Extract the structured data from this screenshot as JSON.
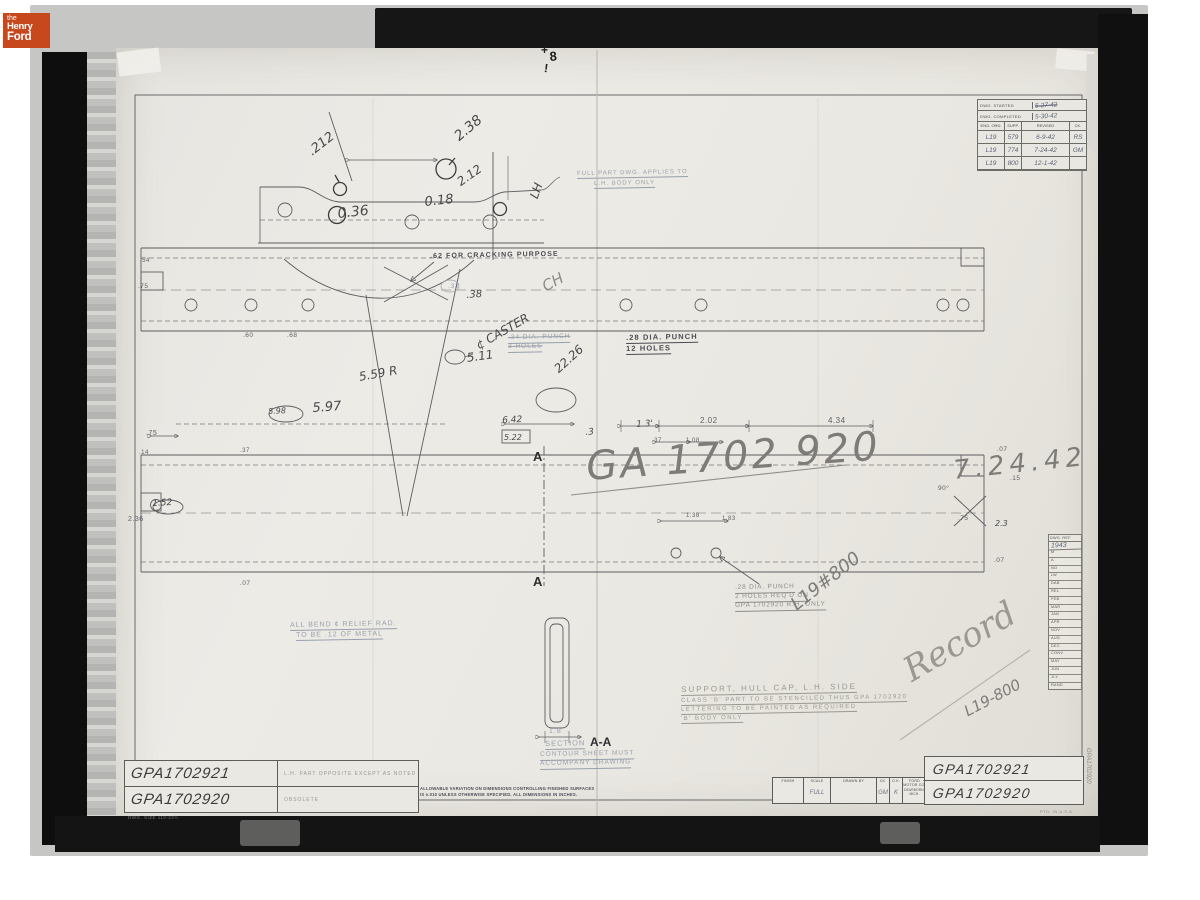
{
  "logo": {
    "the": "the",
    "henry": "Henry",
    "ford": "Ford"
  },
  "revision": {
    "started_label": "DWG. STARTED",
    "started_value": "5-27-42",
    "completed_label": "DWG. COMPLETED",
    "completed_value": "5-30-42",
    "columns": [
      "ENG. ORD.",
      "SUPP.",
      "REVISED",
      "CK."
    ],
    "rows": [
      [
        "L19",
        "579",
        "6-9-42",
        "RS"
      ],
      [
        "L19",
        "774",
        "7-24-42",
        "GM"
      ],
      [
        "L19",
        "800",
        "12-1-42",
        ""
      ]
    ]
  },
  "calendar": {
    "header": "DWG. REF.",
    "year": "1943",
    "rows": [
      "M",
      "A",
      "NO",
      "LW",
      "DAB",
      "REL",
      "FEB",
      "MAR",
      "JAN",
      "APR",
      "NOV",
      "AUG",
      "DEC",
      "CONV",
      "MAY",
      "JUN",
      "JLY",
      "RAND"
    ]
  },
  "title_left": {
    "rows": [
      {
        "number": "GPA1702921",
        "desc": "L.H. PART OPPOSITE EXCEPT AS NOTED"
      },
      {
        "number": "GPA1702920",
        "desc": "OBSOLETE"
      }
    ],
    "size_note": "DWG. SIZE 110-22½"
  },
  "title_right": {
    "cells": [
      {
        "label": "FINISH",
        "value": ""
      },
      {
        "label": "SCALE",
        "value": "FULL"
      },
      {
        "label": "DRAWN BY",
        "value": ""
      },
      {
        "label": "CK.",
        "value": "GM"
      },
      {
        "label": "O.K.",
        "value": "K"
      },
      {
        "label": "FORD MOTOR CO.",
        "value": "DEARBORN, MICH."
      }
    ],
    "numbers": [
      "GPA1702921",
      "GPA1702920"
    ],
    "ptd": "PTD. IN U.S.A."
  },
  "tolerance_note": {
    "line1": "ALLOWABLE VARIATION ON DIMENSIONS CONTROLLING FINISHED SURFACES",
    "line2": "IS ±.010 UNLESS OTHERWISE SPECIFIED.   ALL DIMENSIONS IN INCHES."
  },
  "annotations": [
    {
      "n": "dim-212",
      "t": ".212",
      "x": 306,
      "y": 148,
      "s": 13,
      "r": -38,
      "c": "hand"
    },
    {
      "n": "dim-238",
      "t": "2.38",
      "x": 452,
      "y": 133,
      "s": 14,
      "r": -40,
      "c": "hand"
    },
    {
      "n": "dim-212v",
      "t": "2.12",
      "x": 455,
      "y": 178,
      "s": 12,
      "r": -35,
      "c": "hand"
    },
    {
      "n": "dim-018",
      "t": "0.18",
      "x": 424,
      "y": 196,
      "s": 13,
      "r": -6,
      "c": "hand"
    },
    {
      "n": "dim-036",
      "t": "0.36",
      "x": 337,
      "y": 207,
      "s": 14,
      "r": -6,
      "c": "hand"
    },
    {
      "n": "lh-mark",
      "t": "LH",
      "x": 528,
      "y": 196,
      "s": 12,
      "r": -70,
      "c": "hand"
    },
    {
      "n": "note-top-faint1",
      "t": "FULL PART DWG. APPLIES TO",
      "x": 577,
      "y": 171,
      "s": 6,
      "r": -1,
      "c": "faintblue",
      "u": 1
    },
    {
      "n": "note-top-faint2",
      "t": "L.H. BODY ONLY",
      "x": 594,
      "y": 181,
      "s": 6,
      "r": -1,
      "c": "faintblue",
      "u": 1
    },
    {
      "n": "fold-mark-plus",
      "t": "+",
      "x": 541,
      "y": 44,
      "s": 12,
      "r": 0,
      "c": "mark"
    },
    {
      "n": "fold-mark-8",
      "t": "8",
      "x": 549,
      "y": 50,
      "s": 13,
      "r": -5,
      "c": "mark"
    },
    {
      "n": "fold-mark-excl",
      "t": "!",
      "x": 545,
      "y": 62,
      "s": 12,
      "r": 8,
      "c": "mark"
    },
    {
      "n": "note-cracking",
      "t": ".62 FOR CRACKING PURPOSE",
      "x": 430,
      "y": 253,
      "s": 7,
      "r": -1,
      "c": "lettered"
    },
    {
      "n": "dim-37-circled",
      "t": ".37",
      "x": 448,
      "y": 284,
      "s": 6.5,
      "r": 0,
      "c": "faintblue"
    },
    {
      "n": "dim-38",
      "t": ".38",
      "x": 466,
      "y": 291,
      "s": 10,
      "r": -4,
      "c": "hand"
    },
    {
      "n": "mark-ch",
      "t": "CH",
      "x": 540,
      "y": 281,
      "s": 15,
      "r": -28,
      "c": "handbig"
    },
    {
      "n": "note-punch34a",
      "t": ".34 DIA. PUNCH",
      "x": 508,
      "y": 335,
      "s": 6.5,
      "r": -1,
      "c": "faintblue struck",
      "u": 1
    },
    {
      "n": "note-punch34b",
      "t": "3 HOLES",
      "x": 508,
      "y": 344,
      "s": 6.5,
      "r": -1,
      "c": "faintblue struck",
      "u": 1
    },
    {
      "n": "note-punch28a",
      "t": ".28 DIA. PUNCH",
      "x": 626,
      "y": 334,
      "s": 7.5,
      "r": -1,
      "c": "lettered",
      "u": 1
    },
    {
      "n": "note-punch28b",
      "t": "12 HOLES",
      "x": 626,
      "y": 345,
      "s": 7.5,
      "r": -1,
      "c": "lettered",
      "u": 1
    },
    {
      "n": "dim-60",
      "t": ".60",
      "x": 243,
      "y": 333,
      "s": 6.5,
      "r": 0,
      "c": "print"
    },
    {
      "n": "dim-68",
      "t": ".68",
      "x": 287,
      "y": 333,
      "s": 6.5,
      "r": 0,
      "c": "print"
    },
    {
      "n": "note-caster",
      "t": "¢ CASTER",
      "x": 474,
      "y": 341,
      "s": 12,
      "r": -30,
      "c": "hand"
    },
    {
      "n": "dim-559r",
      "t": "5.59 R",
      "x": 358,
      "y": 371,
      "s": 12,
      "r": -10,
      "c": "hand"
    },
    {
      "n": "dim-511",
      "t": "5.11",
      "x": 466,
      "y": 352,
      "s": 12,
      "r": -8,
      "c": "hand"
    },
    {
      "n": "dim-2226",
      "t": "22.26",
      "x": 552,
      "y": 366,
      "s": 12,
      "r": -42,
      "c": "hand"
    },
    {
      "n": "dim-597",
      "t": "5.97",
      "x": 312,
      "y": 402,
      "s": 13,
      "r": -4,
      "c": "hand"
    },
    {
      "n": "dim-598",
      "t": "5.98",
      "x": 268,
      "y": 408,
      "s": 8,
      "r": -3,
      "c": "hand"
    },
    {
      "n": "dim-75-left",
      "t": ".75",
      "x": 146,
      "y": 430,
      "s": 7,
      "r": 0,
      "c": "print"
    },
    {
      "n": "dim-14",
      "t": ".14",
      "x": 139,
      "y": 450,
      "s": 6,
      "r": 0,
      "c": "print"
    },
    {
      "n": "dim-37-left",
      "t": ".37",
      "x": 240,
      "y": 448,
      "s": 6,
      "r": 0,
      "c": "print"
    },
    {
      "n": "dim-642",
      "t": "6.42",
      "x": 502,
      "y": 417,
      "s": 9,
      "r": -3,
      "c": "hand"
    },
    {
      "n": "dim-522",
      "t": "5.22",
      "x": 504,
      "y": 434,
      "s": 8,
      "r": 0,
      "c": "hand"
    },
    {
      "n": "dim-3",
      "t": ".3",
      "x": 585,
      "y": 429,
      "s": 9,
      "r": -5,
      "c": "hand"
    },
    {
      "n": "dim-13",
      "t": "1.3'",
      "x": 636,
      "y": 421,
      "s": 9,
      "r": -3,
      "c": "hand"
    },
    {
      "n": "dim-202",
      "t": "2.02",
      "x": 700,
      "y": 417,
      "s": 8,
      "r": 0,
      "c": "print"
    },
    {
      "n": "dim-434",
      "t": "4.34",
      "x": 828,
      "y": 417,
      "s": 8,
      "r": 0,
      "c": "print"
    },
    {
      "n": "dim-37-mid",
      "t": ".37",
      "x": 652,
      "y": 438,
      "s": 6,
      "r": 0,
      "c": "print"
    },
    {
      "n": "dim-108",
      "t": "1.08",
      "x": 686,
      "y": 438,
      "s": 6,
      "r": 0,
      "c": "print"
    },
    {
      "n": "big-part-number",
      "t": "GA 1702 920",
      "x": 585,
      "y": 447,
      "s": 40,
      "r": -4,
      "c": "graphite",
      "ls": 3
    },
    {
      "n": "date-7-24-42",
      "t": "7.24.42",
      "x": 952,
      "y": 458,
      "s": 26,
      "r": -6,
      "c": "graphite",
      "ls": 5
    },
    {
      "n": "dim-152",
      "t": "1.52",
      "x": 152,
      "y": 500,
      "s": 9,
      "r": -3,
      "c": "hand"
    },
    {
      "n": "dim-236",
      "t": "2.36",
      "x": 128,
      "y": 516,
      "s": 7,
      "r": 0,
      "c": "print"
    },
    {
      "n": "dim-138",
      "t": "1.38",
      "x": 686,
      "y": 513,
      "s": 6,
      "r": 0,
      "c": "print"
    },
    {
      "n": "dim-183",
      "t": "1.83",
      "x": 722,
      "y": 516,
      "s": 6,
      "r": 0,
      "c": "print"
    },
    {
      "n": "dim-07-r1",
      "t": ".07",
      "x": 997,
      "y": 447,
      "s": 6.5,
      "r": 0,
      "c": "print"
    },
    {
      "n": "dim-90deg",
      "t": "90°",
      "x": 938,
      "y": 486,
      "s": 6.5,
      "r": 0,
      "c": "print"
    },
    {
      "n": "dim-15",
      "t": ".15",
      "x": 1010,
      "y": 476,
      "s": 6.5,
      "r": 0,
      "c": "print"
    },
    {
      "n": "dim-75-right",
      "t": ".75",
      "x": 958,
      "y": 516,
      "s": 6.5,
      "r": 0,
      "c": "print"
    },
    {
      "n": "dim-23",
      "t": "2.3",
      "x": 995,
      "y": 520,
      "s": 8,
      "r": 0,
      "c": "hand"
    },
    {
      "n": "dim-07-r2",
      "t": ".07",
      "x": 994,
      "y": 558,
      "s": 6.5,
      "r": 0,
      "c": "print"
    },
    {
      "n": "dim-07-left",
      "t": ".07",
      "x": 240,
      "y": 581,
      "s": 6.5,
      "r": 0,
      "c": "print"
    },
    {
      "n": "dim-54",
      "t": ".54",
      "x": 140,
      "y": 258,
      "s": 6,
      "r": 0,
      "c": "print"
    },
    {
      "n": "dim-75-band",
      "t": ".75",
      "x": 138,
      "y": 284,
      "s": 6.5,
      "r": 0,
      "c": "print"
    },
    {
      "n": "section-mark-a-top",
      "t": "A",
      "x": 533,
      "y": 450,
      "s": 13,
      "r": 0,
      "c": "amark"
    },
    {
      "n": "section-mark-a-bottom",
      "t": "A",
      "x": 533,
      "y": 575,
      "s": 13,
      "r": 0,
      "c": "amark"
    },
    {
      "n": "note-bend1",
      "t": "ALL BEND ¢ RELIEF RAD.",
      "x": 290,
      "y": 622,
      "s": 7,
      "r": -1,
      "c": "faintblue",
      "u": 1
    },
    {
      "n": "note-bend2",
      "t": "TO BE .12 OF METAL",
      "x": 296,
      "y": 632,
      "s": 7,
      "r": -1,
      "c": "faintblue",
      "u": 1
    },
    {
      "n": "note-punch2a",
      "t": ".28 DIA. PUNCH",
      "x": 735,
      "y": 585,
      "s": 6.5,
      "r": -1,
      "c": "faintlet",
      "u": 1
    },
    {
      "n": "note-punch2b",
      "t": "2 HOLES REQ'D ON",
      "x": 735,
      "y": 594,
      "s": 6.5,
      "r": -1,
      "c": "faintlet",
      "u": 1
    },
    {
      "n": "note-punch2c",
      "t": "GPA 1702920  R.H. ONLY",
      "x": 735,
      "y": 603,
      "s": 6.5,
      "r": -1,
      "c": "faintlet",
      "u": 1
    },
    {
      "n": "hand-l19-800a",
      "t": "L19#800",
      "x": 788,
      "y": 600,
      "s": 18,
      "r": -38,
      "c": "graphite"
    },
    {
      "n": "section-dim-18",
      "t": "1.8",
      "x": 549,
      "y": 728,
      "s": 7,
      "r": 0,
      "c": "faintblue"
    },
    {
      "n": "section-label",
      "t": "SECTION",
      "x": 545,
      "y": 740,
      "s": 7.5,
      "r": -1,
      "c": "faintblue",
      "u": 1
    },
    {
      "n": "section-label-aa",
      "t": "A-A",
      "x": 590,
      "y": 736,
      "s": 12,
      "r": 0,
      "c": "amark"
    },
    {
      "n": "section-note1",
      "t": "CONTOUR SHEET MUST",
      "x": 540,
      "y": 752,
      "s": 6.5,
      "r": -1,
      "c": "faintblue",
      "u": 1
    },
    {
      "n": "section-note2",
      "t": "ACCOMPANY DRAWING",
      "x": 540,
      "y": 761,
      "s": 6.5,
      "r": -1,
      "c": "faintblue",
      "u": 1
    },
    {
      "n": "part-desc-1",
      "t": "SUPPORT, HULL CAP, L.H. SIDE",
      "x": 681,
      "y": 686,
      "s": 8,
      "r": -1,
      "c": "faint",
      "u": 1,
      "ls": 2
    },
    {
      "n": "part-desc-2",
      "t": "CLASS 'B' PART TO BE STENCILED THUS GPA 1702920",
      "x": 681,
      "y": 698,
      "s": 6,
      "r": -1,
      "c": "faint",
      "u": 1
    },
    {
      "n": "part-desc-3",
      "t": "LETTERING TO BE PAINTED AS REQUIRED",
      "x": 681,
      "y": 707,
      "s": 6,
      "r": -1,
      "c": "faint",
      "u": 1
    },
    {
      "n": "part-desc-4",
      "t": "'B' BODY ONLY",
      "x": 681,
      "y": 716,
      "s": 6,
      "r": -1,
      "c": "faint",
      "u": 1
    },
    {
      "n": "hand-record",
      "t": "Record",
      "x": 898,
      "y": 658,
      "s": 34,
      "r": -30,
      "c": "script"
    },
    {
      "n": "hand-l19-800b",
      "t": "L19-800",
      "x": 962,
      "y": 706,
      "s": 15,
      "r": -28,
      "c": "graphite"
    },
    {
      "n": "edge-vertical-number",
      "t": "GPA1702920",
      "x": 1085,
      "y": 748,
      "s": 6,
      "r": 0,
      "c": "vert"
    }
  ]
}
